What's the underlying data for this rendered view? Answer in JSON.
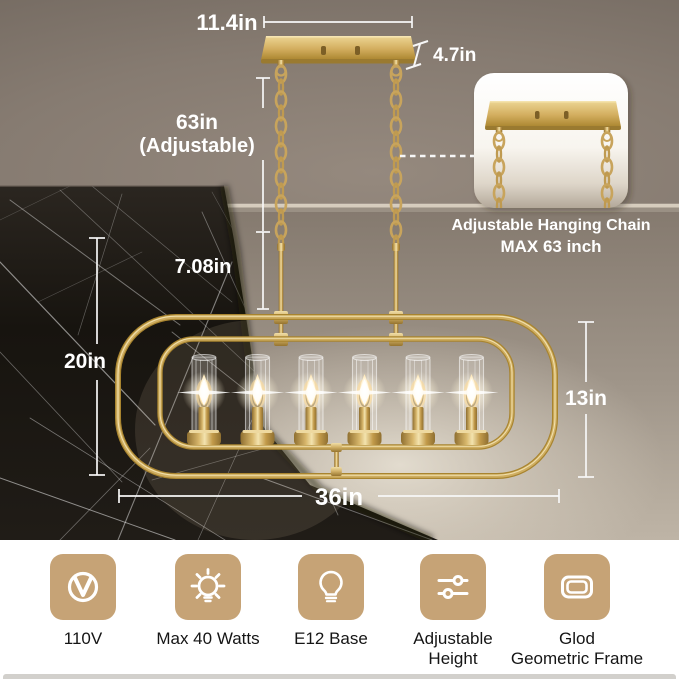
{
  "product_view": {
    "measurements": {
      "canopy_width": "11.4in",
      "canopy_depth": "4.7in",
      "chain_length": "63in",
      "chain_note": "(Adjustable)",
      "stem_length": "7.08in",
      "overall_height": "20in",
      "frame_height": "13in",
      "frame_width": "36in"
    },
    "inset": {
      "caption_line1": "Adjustable Hanging Chain",
      "caption_line2": "MAX 63 inch"
    }
  },
  "features": [
    {
      "icon": "voltage-icon",
      "label": "110V"
    },
    {
      "icon": "wattage-icon",
      "label": "Max 40 Watts"
    },
    {
      "icon": "bulb-base-icon",
      "label": "E12 Base"
    },
    {
      "icon": "sliders-icon",
      "label": "Adjustable\nHeight"
    },
    {
      "icon": "frame-icon",
      "label": "Glod\nGeometric Frame"
    }
  ],
  "colors": {
    "gold": "#c8a45c",
    "icon_tile": "#c6a376",
    "annotation_text": "#ffffff",
    "marble": "#16130f"
  }
}
